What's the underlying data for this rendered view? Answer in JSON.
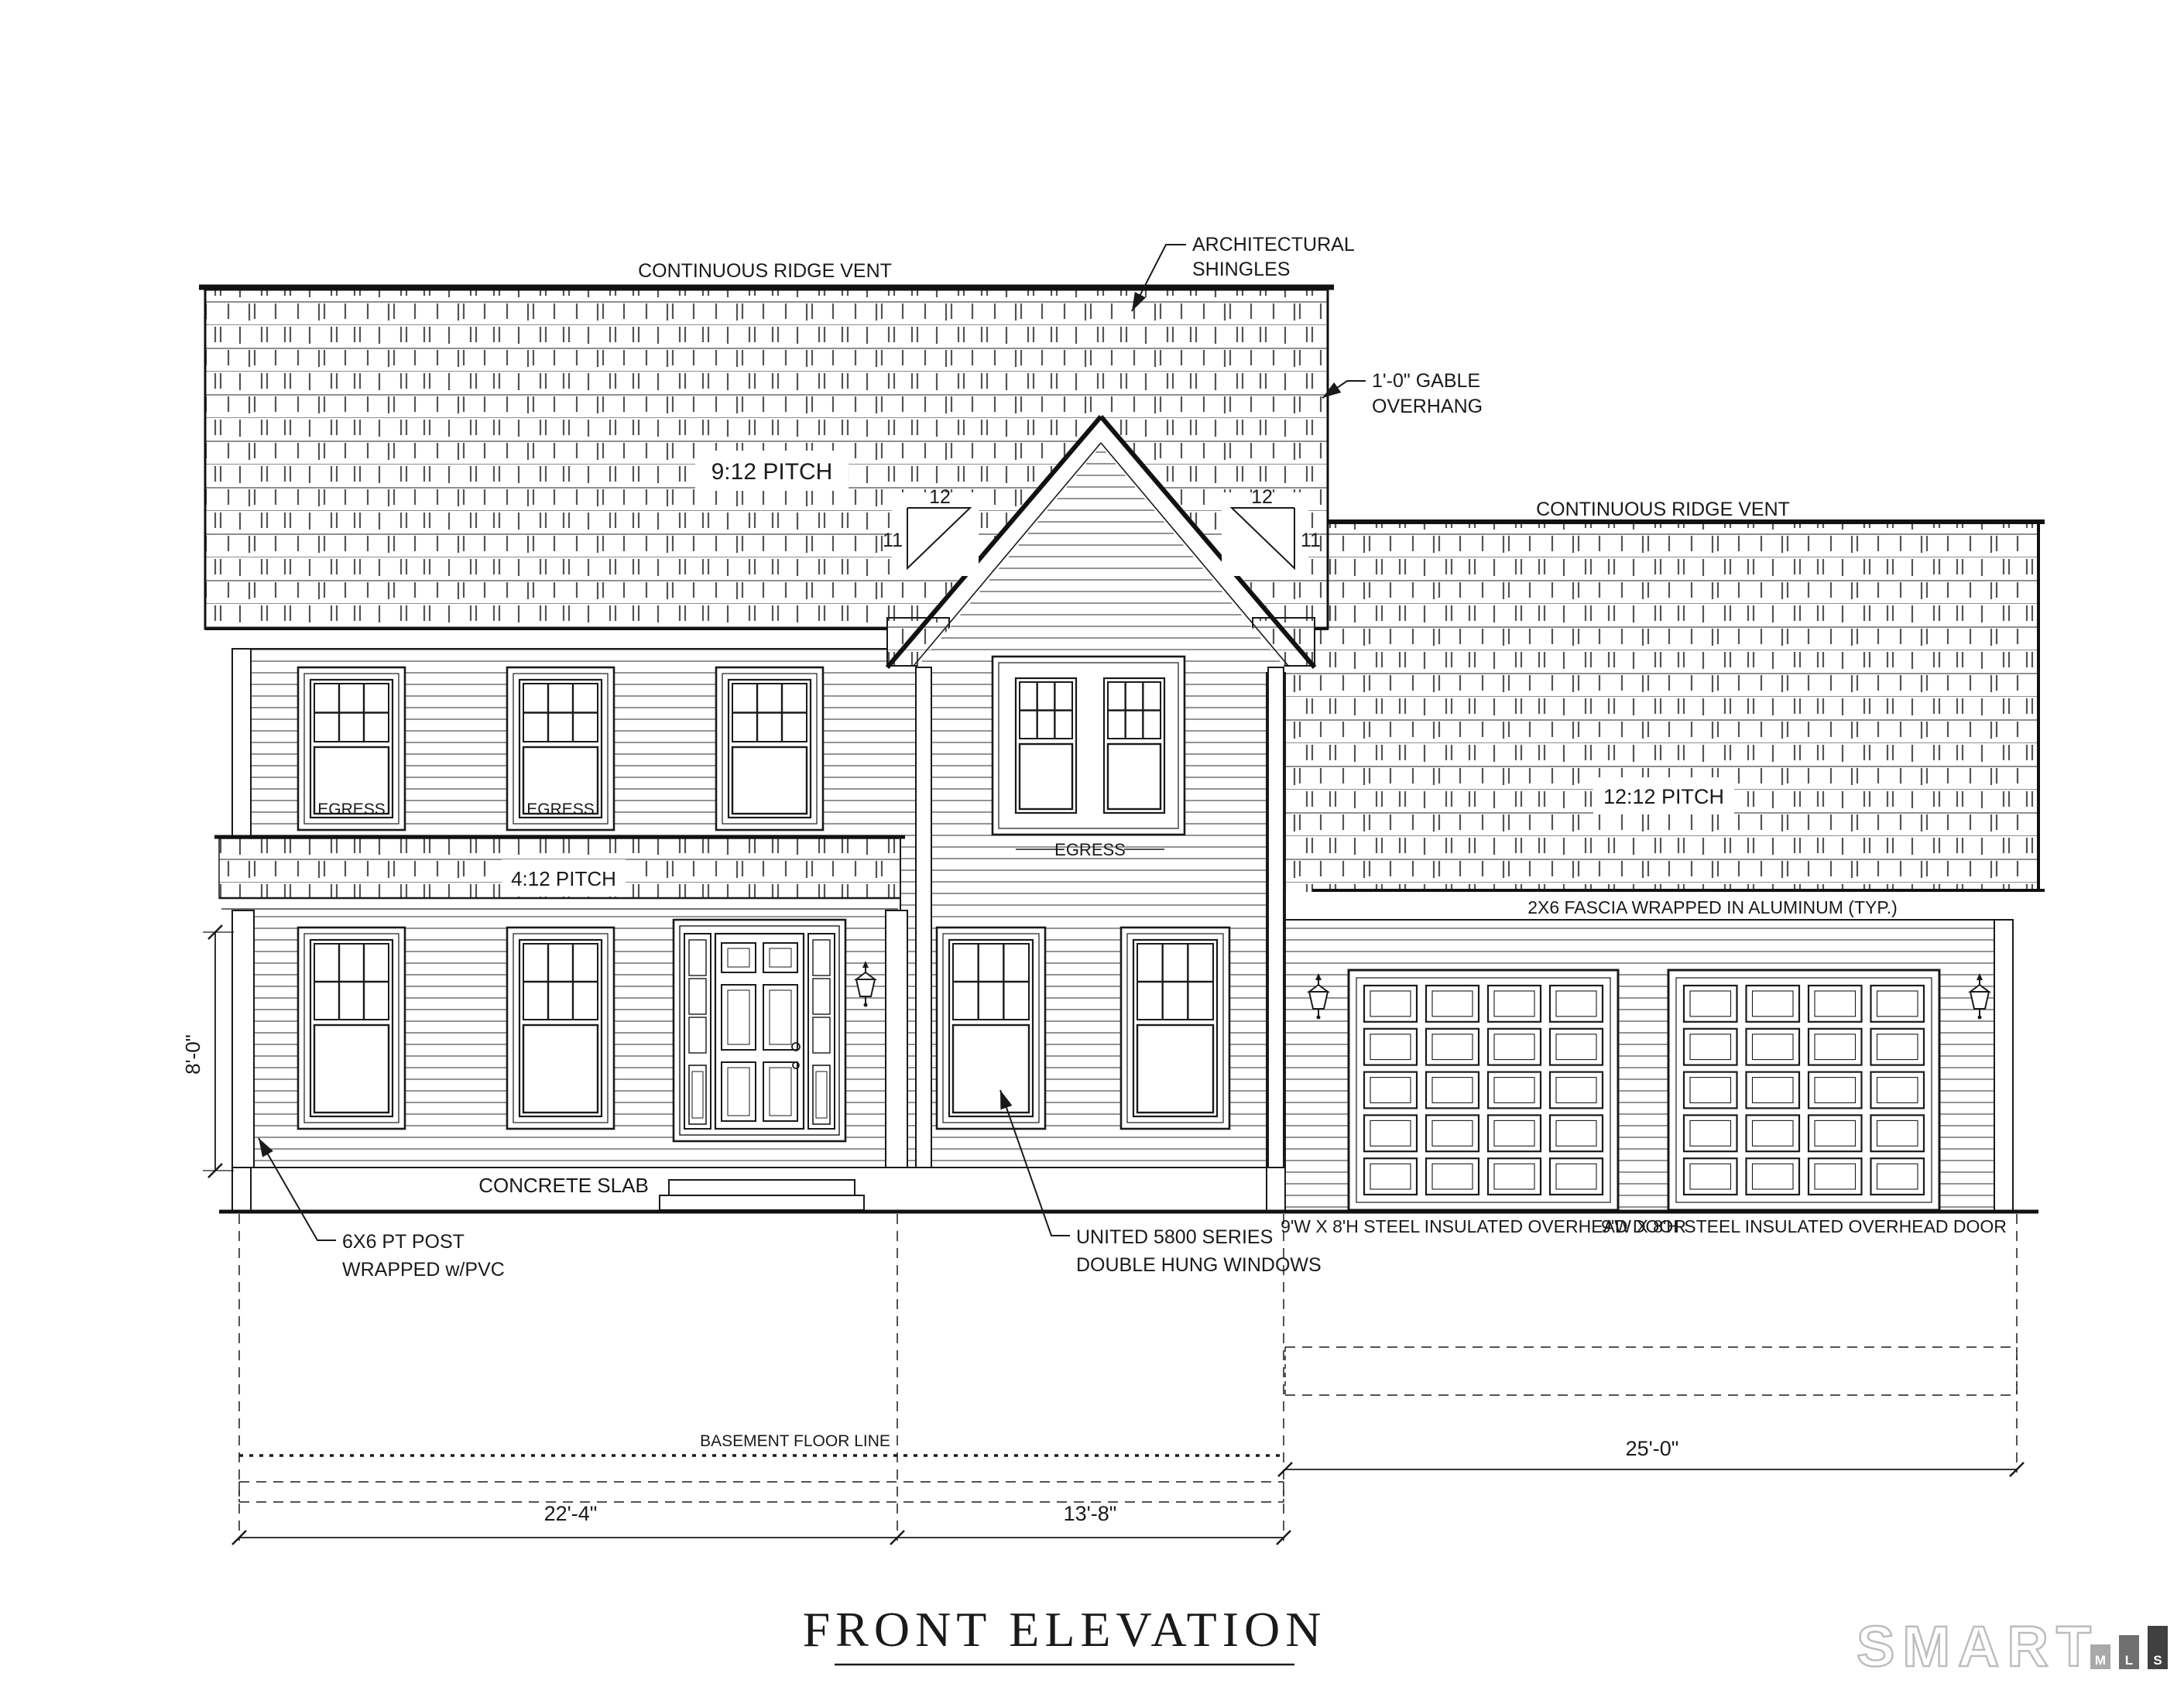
{
  "colors": {
    "line": "#1a1a1a",
    "pattern_line": "#555555",
    "logo_outline": "#bdbdbd",
    "logo_bar_m": "#a9a9a9",
    "logo_bar_l": "#707070",
    "logo_bar_s": "#404040"
  },
  "annotations": {
    "ridge_vent": "CONTINUOUS RIDGE VENT",
    "architectural_shingles_line1": "ARCHITECTURAL",
    "architectural_shingles_line2": "SHINGLES",
    "gable_overhang_line1": "1'-0\" GABLE",
    "gable_overhang_line2": "OVERHANG",
    "main_roof_pitch": "9:12 PITCH",
    "garage_roof_pitch": "12:12 PITCH",
    "porch_roof_pitch": "4:12 PITCH",
    "gable_pitch_run": "12",
    "gable_pitch_rise": "11",
    "fascia_note": "2X6 FASCIA WRAPPED IN ALUMINUM (TYP.)",
    "egress": "EGRESS",
    "concrete_slab": "CONCRETE SLAB",
    "post_note_line1": "6X6 PT POST",
    "post_note_line2": "WRAPPED w/PVC",
    "window_note_line1": "UNITED 5800 SERIES",
    "window_note_line2": "DOUBLE HUNG WINDOWS",
    "garage_door_note": "9'W X 8'H STEEL INSULATED OVERHEAD DOOR",
    "basement_floor_line": "BASEMENT FLOOR LINE"
  },
  "dimensions": {
    "left_section_width": "22'-4\"",
    "entry_section_width": "13'-8\"",
    "garage_width": "25'-0\"",
    "porch_height": "8'-0\""
  },
  "title": "FRONT ELEVATION",
  "watermark": {
    "brand": "SMART",
    "letters": [
      "M",
      "L",
      "S"
    ]
  }
}
